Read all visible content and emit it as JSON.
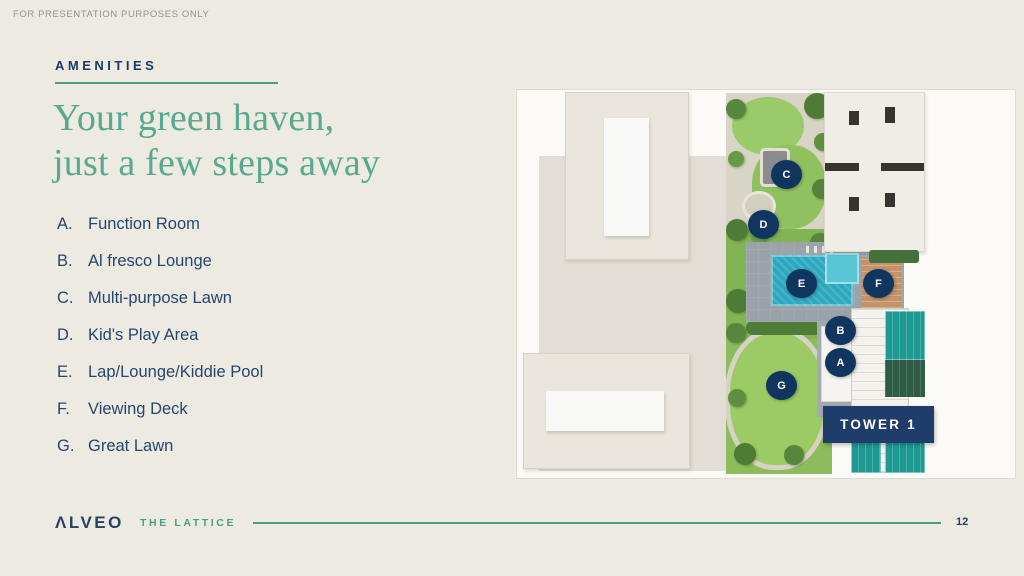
{
  "slide": {
    "disclaimer": "FOR PRESENTATION PURPOSES ONLY",
    "section_label": "AMENITIES",
    "title_line1": "Your green haven,",
    "title_line2": "just a few steps away"
  },
  "amenities": [
    {
      "letter": "A.",
      "label": "Function Room"
    },
    {
      "letter": "B.",
      "label": "Al fresco Lounge"
    },
    {
      "letter": "C.",
      "label": "Multi-purpose Lawn"
    },
    {
      "letter": "D.",
      "label": "Kid's Play Area"
    },
    {
      "letter": "E.",
      "label": "Lap/Lounge/Kiddie Pool"
    },
    {
      "letter": "F.",
      "label": "Viewing Deck"
    },
    {
      "letter": "G.",
      "label": "Great Lawn"
    }
  ],
  "map": {
    "tower_label": "TOWER 1",
    "markers": [
      {
        "letter": "C"
      },
      {
        "letter": "D"
      },
      {
        "letter": "E"
      },
      {
        "letter": "F"
      },
      {
        "letter": "B"
      },
      {
        "letter": "A"
      },
      {
        "letter": "G"
      }
    ]
  },
  "footer": {
    "brand": "ΛLVEO",
    "project": "THE LATTICE",
    "page_number": "12"
  },
  "colors": {
    "slide_bg": "#EDEAE2",
    "accent_navy": "#1B3A67",
    "text_navy": "#26466E",
    "heading_green": "#57AA8F",
    "brand_teal": "#4E9C87",
    "marker_navy": "#10355F",
    "tower_navy": "#1F3D6A",
    "pool_teal": "#2CA9BF",
    "lawn_green": "#8CBC5B",
    "disclaimer_gray": "#95928B"
  }
}
